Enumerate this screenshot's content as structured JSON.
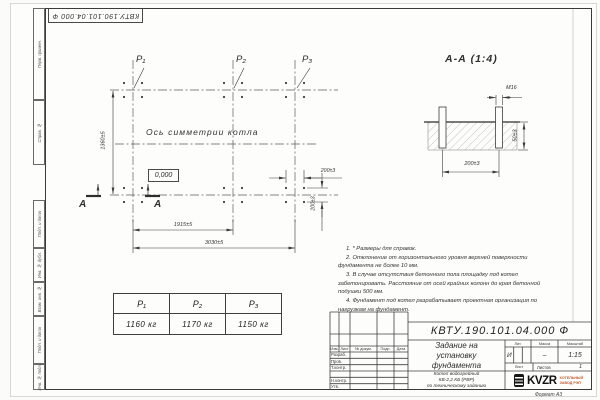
{
  "frame": {
    "top_designation": "КВТУ.190.101.04.000 Ф",
    "margin_labels": [
      "Перв. примен.",
      "Справ. №",
      "Подп. и дата",
      "Инв. № дубл.",
      "Взам. инв. №",
      "Подп. и дата",
      "Инв. № подл."
    ],
    "format_label": "Формат А3"
  },
  "plan": {
    "p1": "Р₁",
    "p2": "Р₂",
    "p3": "Р₃",
    "symmetry_axis_label": "Ось симметрии котла",
    "level_mark": "0,000",
    "dim_height": "1360±5",
    "dim_inner_span": "1915±5",
    "dim_outer_span": "3030±5",
    "dim_bolt_spacing_h": "200±3",
    "dim_bolt_spacing_v": "200±3",
    "section_letter": "А"
  },
  "section_view": {
    "title": "А-А (1:4)",
    "thread_label": "М16",
    "dim_width": "200±3",
    "dim_depth": "50±3"
  },
  "notes": [
    "1. * Размеры для справок.",
    "2. Отклонение от горизонтального уровня верхней поверхности фундамента не более 10 мм.",
    "3. В случае отсутствия бетонного пола площадку под котел забетонировать. Расстояние от осей крайних колонн до края бетонной подушки 500 мм.",
    "4. Фундамент под котел разрабатывает проектная организация по нагрузкам на фундамент."
  ],
  "load_table": {
    "headers": [
      "Р₁",
      "Р₂",
      "Р₃"
    ],
    "values": [
      "1160 кг",
      "1170 кг",
      "1150 кг"
    ]
  },
  "title_block": {
    "designation": "КВТУ.190.101.04.000 Ф",
    "doc_title": "Задание на установку фундамента",
    "product_lines": [
      "Котел водогрейный",
      "КВ-2,2 КБ (РВР)",
      "по техническому заданию"
    ],
    "col_izm": "Изм.",
    "col_list": "Лист",
    "col_doc": "№ докум.",
    "col_podp": "Подп.",
    "col_data": "Дата",
    "rows": [
      "Разраб.",
      "Пров.",
      "Т.контр.",
      "",
      "Н.контр.",
      "Утв."
    ],
    "lit_label": "Лит.",
    "mass_label": "Масса",
    "scale_label": "Масштаб",
    "lit_value": "И",
    "mass_value": "–",
    "scale_value": "1:15",
    "sheet_label": "Лист",
    "sheets_label": "Листов",
    "sheets_value": "1",
    "logo": "KVZR",
    "logo_caption_1": "КОТЕЛЬНЫЙ",
    "logo_caption_2": "ЗАВОД РЭП"
  }
}
